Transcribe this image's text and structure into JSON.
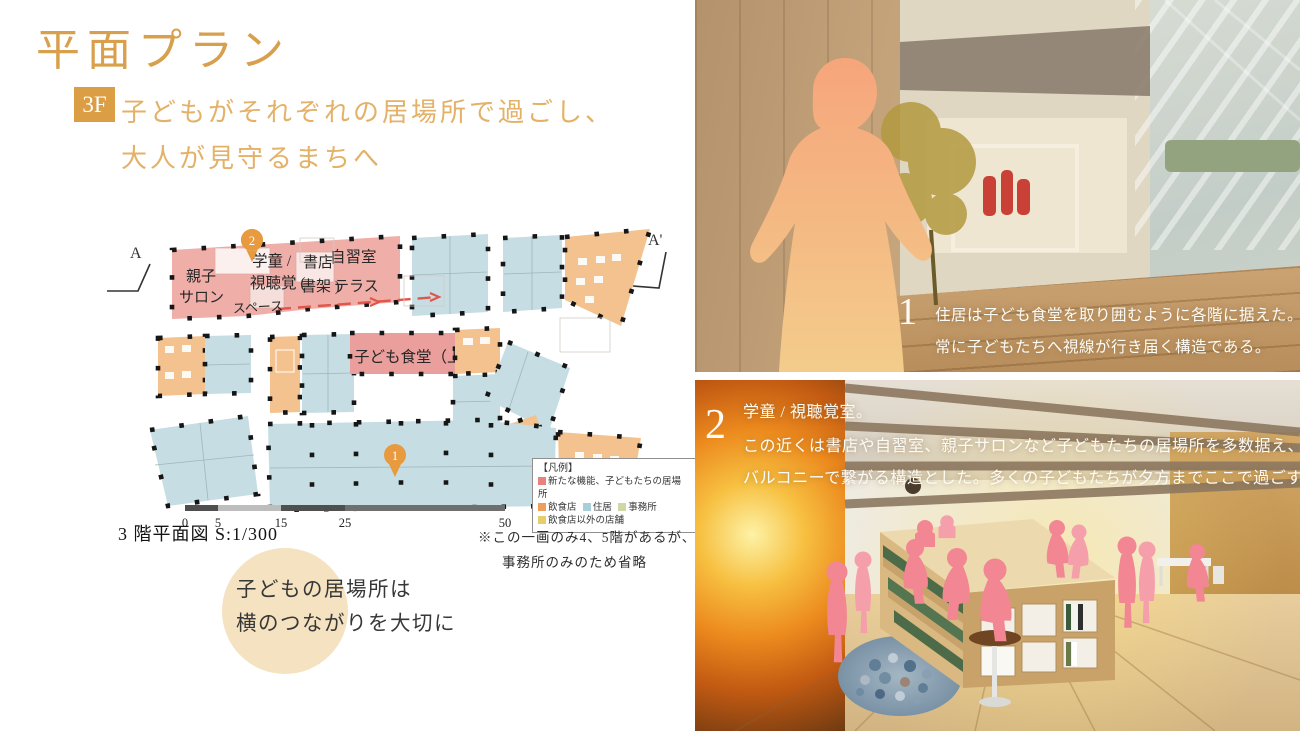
{
  "page": {
    "title": "平面プラン",
    "floor_badge": "3F",
    "subtitle_line1": "子どもがそれぞれの居場所で過ごし、",
    "subtitle_line2": "大人が見守るまちへ",
    "accent_color": "#d8a04c"
  },
  "plan": {
    "caption": "3 階平面図 S:1/300",
    "note_line1": "※この一画のみ4、5階があるが、",
    "note_line2": "事務所のみのため省略",
    "section_marker_left": "A",
    "section_marker_right": "A'",
    "pin_top": "2",
    "pin_bottom": "1",
    "scale_ticks": [
      "0",
      "5",
      "15",
      "25",
      "50"
    ],
    "rooms": {
      "oyako_1": "親子",
      "oyako_2": "サロン",
      "gakudo_1": "学童 /",
      "gakudo_2": "視聴覚 (",
      "shoten_1": "書店",
      "shoten_2": "書架 )",
      "jishu": "自習室",
      "terrace": "テラス",
      "space": "スペース",
      "shokudo": "子ども食堂（上階）"
    },
    "legend": {
      "title": "【凡例】",
      "items": [
        {
          "label": "新たな機能、子どもたちの居場所",
          "color": "#e8827d"
        },
        {
          "label": "飲食店",
          "color": "#ee9f5b"
        },
        {
          "label": "住居",
          "color": "#a9cdd9"
        },
        {
          "label": "事務所",
          "color": "#cdd8a6"
        },
        {
          "label": "飲食店以外の店舗",
          "color": "#e5cf6a"
        }
      ]
    },
    "colors": {
      "kids_place": "#f0aea9",
      "restaurant": "#f4c28e",
      "residence": "#c6dde3",
      "pin": "#e89a3e"
    }
  },
  "highlight_bubble": {
    "line1": "子どもの居場所は",
    "line2": "横のつながりを大切に",
    "bg_color": "#f4e2c0"
  },
  "renderings": {
    "top": {
      "number": "1",
      "caption_line1": "住居は子ども食堂を取り囲むように各階に据えた。",
      "caption_line2": "常に子どもたちへ視線が行き届く構造である。"
    },
    "bottom": {
      "number": "2",
      "caption_line1": "学童 / 視聴覚室。",
      "caption_line2": "この近くは書店や自習室、親子サロンなど子どもたちの居場所を多数据え、",
      "caption_line3": "バルコニーで繋がる構造とした。多くの子どもたちが夕方までここで過ごす。"
    }
  }
}
